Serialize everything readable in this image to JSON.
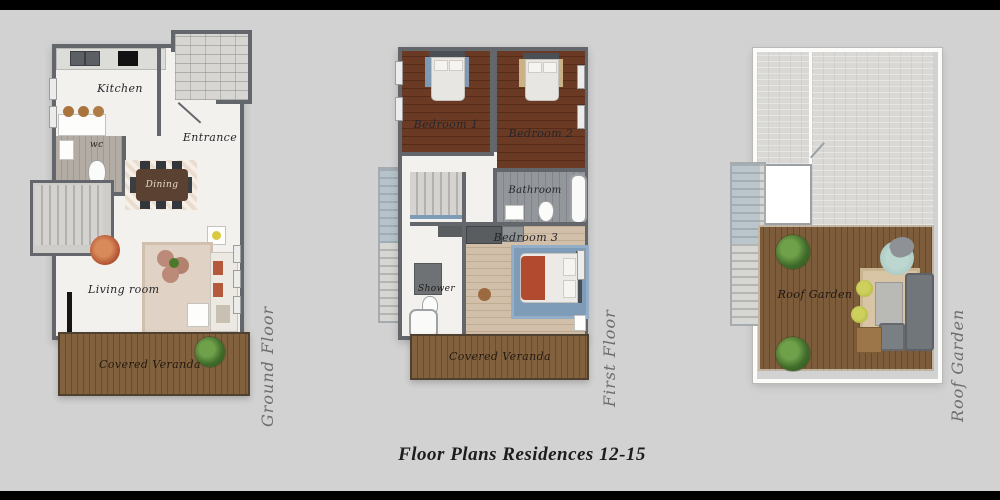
{
  "title": "Floor Plans Residences 12-15",
  "plans": {
    "ground": {
      "side_label": "Ground Floor",
      "rooms": {
        "kitchen": "Kitchen",
        "entrance": "Entrance",
        "wc": "wc",
        "dining": "Dining",
        "living_room": "Living room",
        "veranda": "Covered Veranda"
      }
    },
    "first": {
      "side_label": "First Floor",
      "rooms": {
        "bedroom1": "Bedroom 1",
        "bedroom2": "Bedroom 2",
        "bathroom": "Bathroom",
        "bedroom3": "Bedroom 3",
        "shower": "Shower",
        "veranda": "Covered Veranda"
      }
    },
    "roof": {
      "side_label": "Roof Garden",
      "rooms": {
        "garden": "Roof Garden"
      }
    }
  },
  "colors": {
    "background": "#d2d2d2",
    "letterbox": "#000000",
    "wall": "#63666b",
    "dark_wood": "#5f3526",
    "light_wood": "#cdb9a5",
    "deck_wood": "#7a5939",
    "accent_terracotta": "#b14a2e",
    "accent_blue": "#7e9cb8",
    "plant_green": "#4c7a2d"
  }
}
